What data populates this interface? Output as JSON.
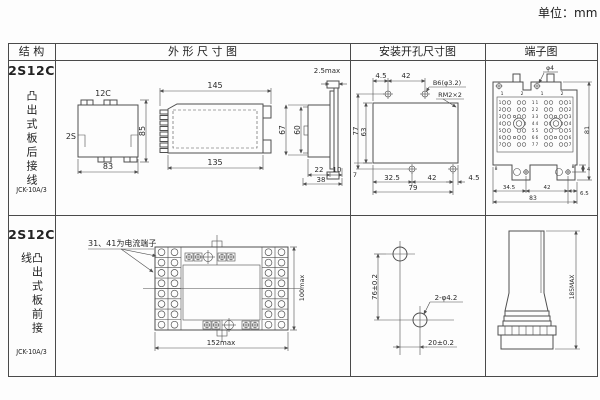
{
  "unit_label": "单位：mm",
  "headers": {
    "structure": "结 构",
    "outline": "外 形 尺 寸 图",
    "mounting": "安装开孔尺寸图",
    "terminal": "端子图"
  },
  "row1": {
    "model": "2S12C",
    "mounting_type": "凸出式板后接线",
    "spec": "JCK-10A/3",
    "outline": {
      "top_label": "12C",
      "side_label": "2S",
      "width": "83",
      "height": "85",
      "front_top": "145",
      "front_bottom": "135",
      "h_outer": "67",
      "h_inner": "60",
      "panel": "2.5max",
      "d1": "22",
      "d2": "10",
      "d_total": "38"
    },
    "mounting": {
      "t1": "4.5",
      "t2": "42",
      "hole_label": "B6(φ3.2)",
      "screw_label": "RM2×2",
      "left_outer": "77",
      "left_inner": "63",
      "left_small": "7",
      "b1": "32.5",
      "b2": "42",
      "b3": "4.5",
      "b_total": "79"
    },
    "terminal": {
      "screw_label": "φ4",
      "right": "81",
      "small": "4",
      "col_nums": [
        "1",
        "2",
        "1",
        "2"
      ],
      "row_nums": [
        "1",
        "2",
        "3",
        "4",
        "5",
        "6",
        "7"
      ],
      "center_nums": [
        "1 1",
        "2 2",
        "3 3",
        "4 4",
        "5 5",
        "6 6",
        "7 7"
      ],
      "foot_left": "8",
      "foot_right": "8",
      "b1": "34.5",
      "b2": "42",
      "b3": "6.5",
      "b_total": "83"
    }
  },
  "row2": {
    "model": "2S12C",
    "mounting_type": "凸出式板前接线",
    "spec": "JCK-10A/3",
    "outline": {
      "note": "31、41为电流端子",
      "width": "152max",
      "height": "100max"
    },
    "mounting": {
      "v": "76±0.2",
      "hole_label": "2-φ4.2",
      "h": "20±0.2"
    },
    "terminal": {
      "height": "185MAX"
    }
  },
  "colors": {
    "line": "#4f4f4f",
    "text": "#222222",
    "background": "#fdfdfd"
  }
}
